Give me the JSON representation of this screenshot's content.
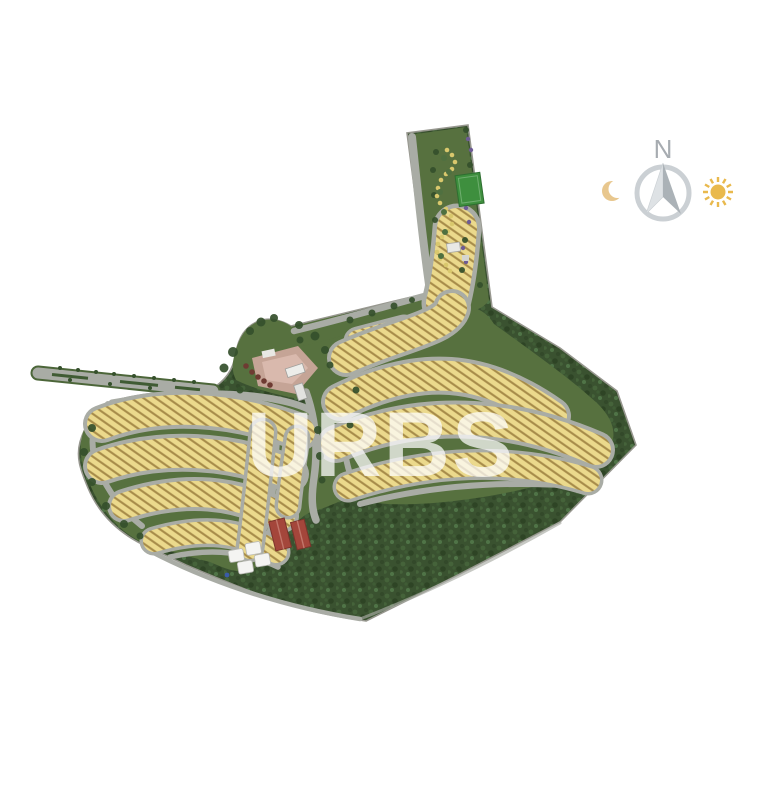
{
  "page": {
    "background": "#ffffff"
  },
  "watermark": {
    "text": "URBS",
    "color": "#ffffff"
  },
  "compass": {
    "label": "N"
  },
  "icons": {
    "moon": "moon-icon",
    "sun": "sun-icon",
    "compass": "compass-rose-icon"
  },
  "map": {
    "colors": {
      "lot": "#EBD98C",
      "lot_hatch": "#A68B49",
      "road": "#A9ACA5",
      "grass": "#57713F",
      "forest": "#3A5230",
      "forest_dark": "#2E4425",
      "forest_light": "#45633A",
      "sports_field": "#3E8F3E",
      "clubhouse_roof": "#A4463B",
      "entrance_plaza": "#CBA69B",
      "tent": "#F4F4F2",
      "tree": "#35502C",
      "garden_path": "#D9C86D",
      "flower_tree": "#6E5C94",
      "outline": "#97978F",
      "moon": "#E8C78E",
      "sun": "#E9B94D",
      "compass_ring": "#CBD0D4",
      "compass_text": "#A7ACB1"
    },
    "features": [
      "west-access-avenue",
      "entrance-plaza",
      "central-boulevard",
      "residential-lot-rows-west",
      "residential-lot-rows-east",
      "central-lot-columns",
      "north-strip-lots",
      "garden-park",
      "sports-field",
      "clubhouse-buildings",
      "event-tents",
      "forest-reserve",
      "perimeter-road"
    ]
  }
}
